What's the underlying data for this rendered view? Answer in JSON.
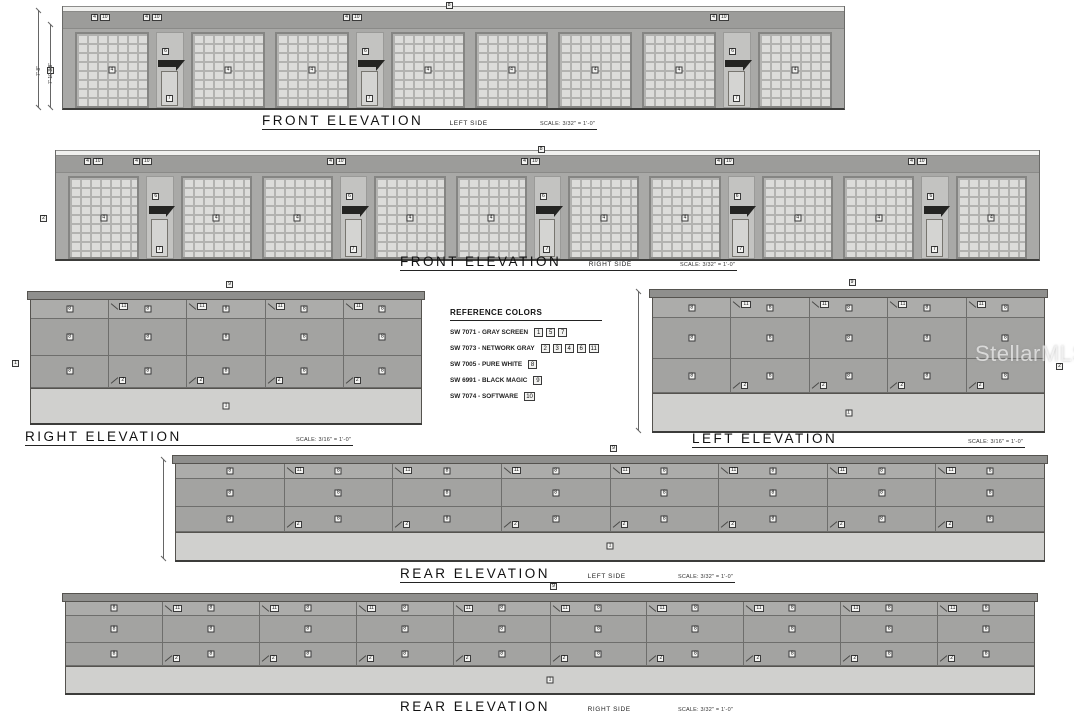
{
  "watermark": "StellarMLS",
  "legend": {
    "title": "REFERENCE COLORS",
    "items": [
      {
        "code": "SW 7071",
        "name": "GRAY SCREEN",
        "tags": [
          "1",
          "5",
          "7"
        ]
      },
      {
        "code": "SW 7073",
        "name": "NETWORK GRAY",
        "tags": [
          "2",
          "3",
          "4",
          "6",
          "11"
        ]
      },
      {
        "code": "SW 7005",
        "name": "PURE WHITE",
        "tags": [
          "8"
        ]
      },
      {
        "code": "SW 6991",
        "name": "BLACK MAGIC",
        "tags": [
          "9"
        ]
      },
      {
        "code": "SW 7074",
        "name": "SOFTWARE",
        "tags": [
          "10"
        ]
      }
    ]
  },
  "elevations": [
    {
      "id": "front-left",
      "type": "front",
      "title": "FRONT ELEVATION",
      "side": "LEFT SIDE",
      "scale": "SCALE: 3/32\" = 1'-0\"",
      "bays": "DEDDEDDDDED",
      "tags": {
        "door": "4",
        "entry_door": "7",
        "awning": "6",
        "edge": "1",
        "top": "8",
        "parapet": [
          "4",
          "10"
        ]
      },
      "dimensions": [
        "7'-8\"",
        "7'-10 3/8\""
      ]
    },
    {
      "id": "front-right",
      "type": "front",
      "title": "FRONT ELEVATION",
      "side": "RIGHT SIDE",
      "scale": "SCALE: 3/32\" = 1'-0\"",
      "bays": "DEDDEDDEDDEDDED",
      "tags": {
        "door": "4",
        "entry_door": "7",
        "awning": "6",
        "edge": "2",
        "top": "8",
        "parapet": [
          "4",
          "10"
        ]
      }
    },
    {
      "id": "right",
      "type": "panel",
      "title": "RIGHT ELEVATION",
      "side": "",
      "scale": "SCALE: 3/16\" = 1'-0\"",
      "cols": 5,
      "edge_side": "left",
      "tags": {
        "panel": "8",
        "top": "11",
        "bottom": "2",
        "base": "1",
        "coping": "9",
        "edge": "1"
      }
    },
    {
      "id": "left",
      "type": "panel",
      "title": "LEFT ELEVATION",
      "side": "",
      "scale": "SCALE: 3/16\" = 1'-0\"",
      "cols": 5,
      "edge_side": "right",
      "tags": {
        "panel": "8",
        "top": "11",
        "bottom": "2",
        "base": "1",
        "coping": "9",
        "edge": "2"
      }
    },
    {
      "id": "rear-left",
      "type": "panel",
      "title": "REAR ELEVATION",
      "side": "LEFT SIDE",
      "scale": "SCALE: 3/32\" = 1'-0\"",
      "cols": 8,
      "tags": {
        "panel": "8",
        "top": "11",
        "bottom": "2",
        "base": "1",
        "coping": "9"
      }
    },
    {
      "id": "rear-right",
      "type": "panel",
      "title": "REAR ELEVATION",
      "side": "RIGHT SIDE",
      "scale": "SCALE: 3/32\" = 1'-0\"",
      "cols": 10,
      "tags": {
        "panel": "8",
        "top": "11",
        "bottom": "2",
        "base": "1",
        "coping": "9"
      }
    }
  ]
}
